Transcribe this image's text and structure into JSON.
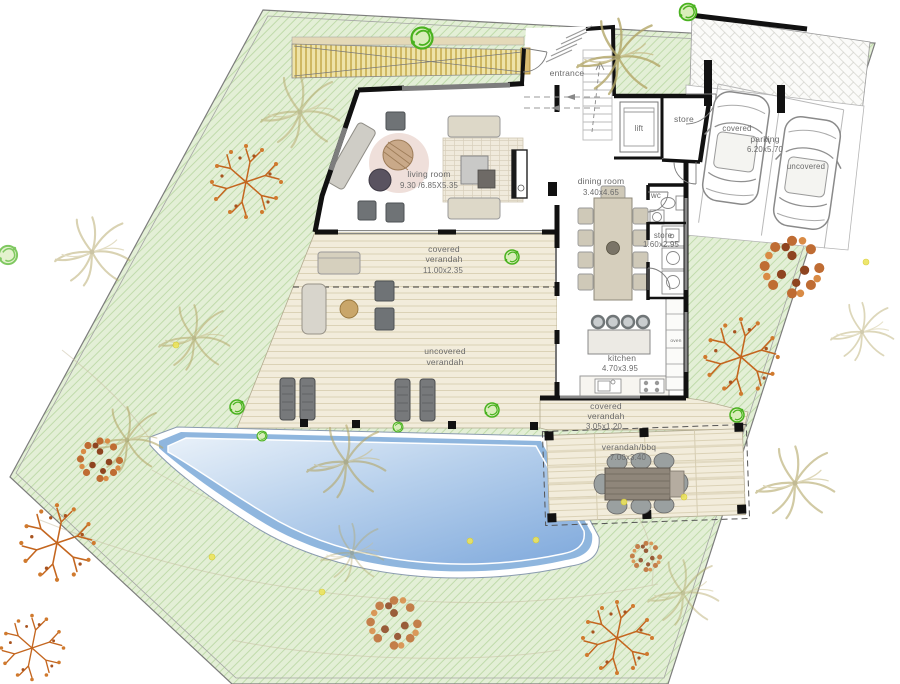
{
  "plan": {
    "labels": {
      "entrance": "entrance",
      "lift": "lift",
      "store_upper": "store",
      "living_room": {
        "name": "living room",
        "dims": "9.30 /6.85X5.35"
      },
      "dining_room": {
        "name": "dining room",
        "dims": "3.40x4.65"
      },
      "wc": "wc",
      "store_lower": {
        "name": "store",
        "dims": "1.60x2.95"
      },
      "kitchen": {
        "name": "kitchen",
        "dims": "4.70x3.95"
      },
      "oven": "oven",
      "covered_verandah": {
        "line1": "covered",
        "line2": "verandah",
        "dims": "11.00x2.35"
      },
      "uncovered_verandah": {
        "line1": "uncovered",
        "line2": "verandah"
      },
      "covered_verandah_rear": {
        "line1": "covered",
        "line2": "verandah",
        "dims": "3.05x1.20"
      },
      "verandah_bbq": {
        "name": "verandah/bbq",
        "dims": "7.00x3.40"
      },
      "parking": {
        "name": "parking",
        "dims": "6.20x5.70",
        "bay_left": "covered",
        "bay_right": "uncovered"
      }
    },
    "colors": {
      "lawn": "#e3efd6",
      "lawn_hatch": "#bcd9a6",
      "pool_water_deep": "#7fa9dc",
      "pool_band": "#8fb6de",
      "deck": "#f2ecdb",
      "ramp": "#eee3a8",
      "wall": "#111111",
      "label_text": "#6a6a6a",
      "tree_orange": "#c4661f",
      "palm_olive": "#b4a768",
      "bush_green": "#49b21f"
    }
  }
}
